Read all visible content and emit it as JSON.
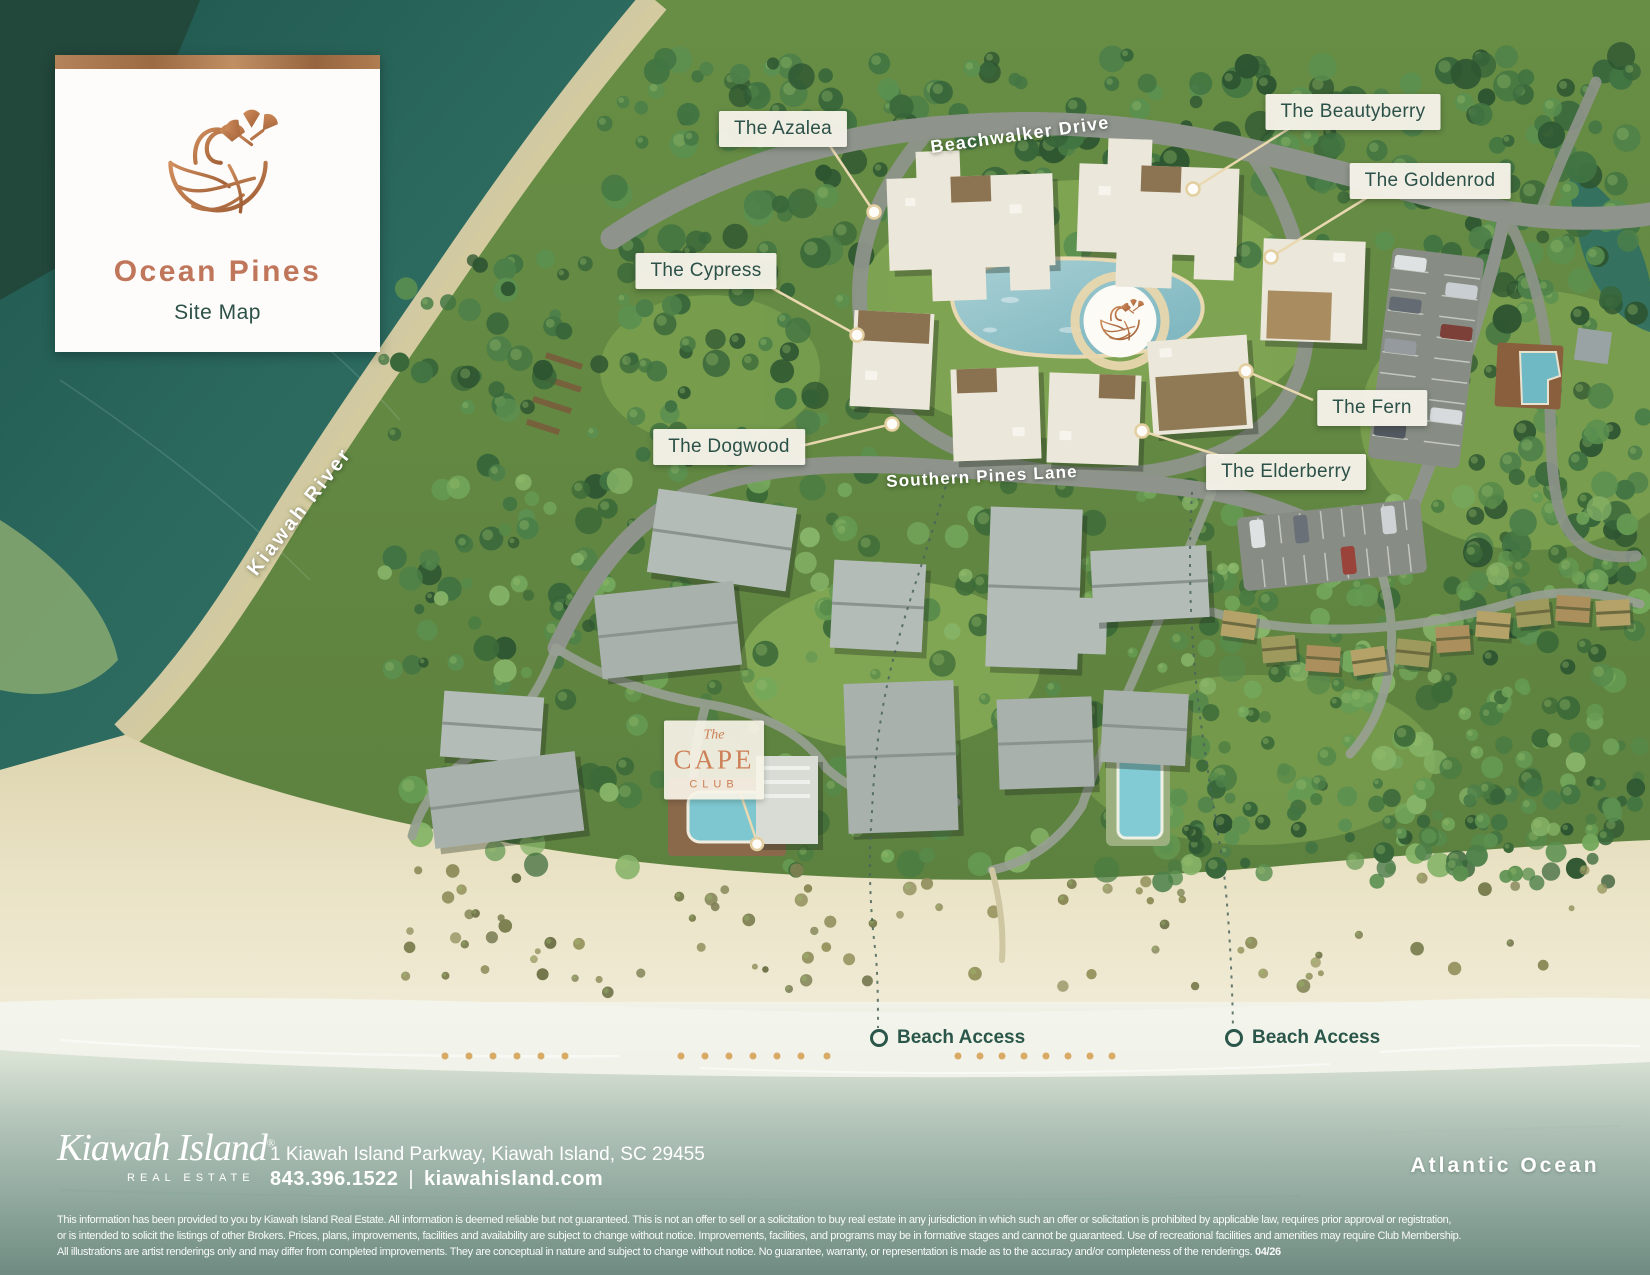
{
  "colors": {
    "accent_copper": "#c0765a",
    "label_green": "#2c5148",
    "leader_cream": "#e9d8b0",
    "river_teal": "#2a655c",
    "ocean_deep": "#6f8b81"
  },
  "brand_card": {
    "title": "Ocean Pines",
    "subtitle": "Site Map"
  },
  "map": {
    "building_labels": [
      {
        "label": "The Azalea"
      },
      {
        "label": "The Beautyberry"
      },
      {
        "label": "The Goldenrod"
      },
      {
        "label": "The Cypress"
      },
      {
        "label": "The Fern"
      },
      {
        "label": "The Dogwood"
      },
      {
        "label": "The Elderberry"
      }
    ],
    "road_labels": [
      {
        "label": "Beachwalker Drive"
      },
      {
        "label": "Southern Pines Lane"
      },
      {
        "label": "Kiawah River"
      }
    ],
    "cape_club": {
      "line1": "The",
      "line2": "CAPE",
      "line3": "CLUB"
    },
    "beach_access": [
      {
        "label": "Beach Access"
      },
      {
        "label": "Beach Access"
      }
    ],
    "ocean_label": "Atlantic Ocean"
  },
  "footer": {
    "brand_script": "Kiawah Island",
    "brand_mark": "®",
    "brand_sub": "REAL ESTATE",
    "address": "1 Kiawah Island Parkway, Kiawah Island, SC 29455",
    "phone": "843.396.1522",
    "separator": "|",
    "website": "kiawahisland.com"
  },
  "disclaimer": {
    "line1": "This information has been provided to you by Kiawah Island Real Estate. All information is deemed reliable but not guaranteed. This is not an offer to sell or a solicitation to buy real estate in any jurisdiction in which such an offer or solicitation is prohibited by applicable law, requires prior approval or registration,",
    "line2": "or is intended to solicit the listings of other Brokers. Prices, plans, improvements, facilities and availability are subject to change without notice. Improvements, facilities, and programs may be in formative stages and cannot be guaranteed. Use of recreational facilities and amenities may require Club Membership.",
    "line3": "All illustrations are artist renderings only and may differ from completed improvements. They are conceptual in nature and subject to change without notice. No guarantee, warranty, or representation is made as to the accuracy and/or completeness of the renderings. ",
    "date": "04/26"
  }
}
